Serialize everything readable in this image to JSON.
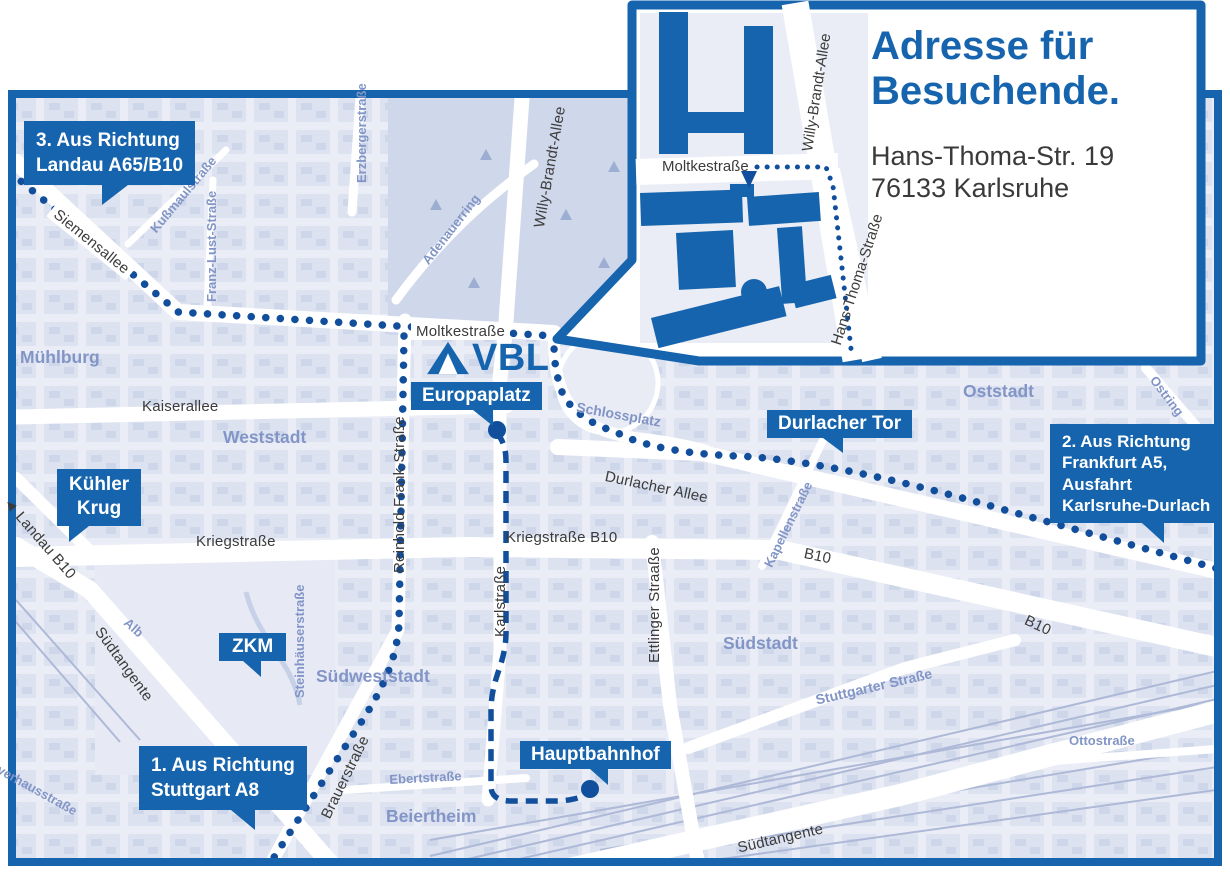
{
  "inset": {
    "title": [
      "Adresse für",
      "Besuchende."
    ],
    "address": [
      "Hans-Thoma-Str. 19",
      "76133 Karlsruhe"
    ],
    "streets": {
      "moltke": "Moltkestraße",
      "willy_brandt": "Willy-Brandt-Allee",
      "hans_thoma": "Hans-Thoma-Straße"
    }
  },
  "logo": {
    "text": "VBL"
  },
  "callouts": {
    "route1": {
      "lines": [
        "1. Aus Richtung",
        "Stuttgart A8"
      ]
    },
    "route2": {
      "lines": [
        "2. Aus Richtung",
        "Frankfurt A5,",
        "Ausfahrt",
        "Karlsruhe-Durlach"
      ]
    },
    "route3": {
      "lines": [
        "3. Aus Richtung",
        "Landau A65/B10"
      ]
    }
  },
  "badges": {
    "europaplatz": "Europaplatz",
    "durlacher_tor": "Durlacher Tor",
    "kuehler_krug": [
      "Kühler",
      "Krug"
    ],
    "zkm": "ZKM",
    "hauptbahnhof": "Hauptbahnhof"
  },
  "roads": {
    "siemensallee": "Siemensallee",
    "kussmaulstrasse": "Kußmaulstraße",
    "franz_lust": "Franz-Lust-Straße",
    "erzbergerstrasse": "Erzbergerstraße",
    "adenauerring": "Adenauerring",
    "willy_brandt": "Willy-Brandt-Allee",
    "moltkestrasse": "Moltkestraße",
    "kaiserallee": "Kaiserallee",
    "reinhold_frank": "Reinhold-Frank-Straße",
    "landau_arrow": "◄",
    "landau": "Landau B10",
    "kriegstrasse": "Kriegstraße",
    "kriegstrasse_b10": "Kriegstraße B10",
    "karlstrasse": "Karlstraße",
    "ettlinger": "Ettlinger Straaße",
    "durlacher_allee": "Durlacher Allee",
    "kapellenstrasse": "Kapellenstraße",
    "b10_west": "B10",
    "b10_east": "B10",
    "ostring": "Ostring",
    "stuttgarter": "Stuttgarter Straße",
    "steinhaeuser": "Steinhäuserstraße",
    "brauerstrasse": "Brauerstraße",
    "ebertstrasse": "Ebertstraße",
    "ottostrasse": "Ottostraße",
    "suedtangente_w": "Südtangente",
    "suedtangente_s": "Südtangente",
    "alb": "Alb",
    "pulverhaus": "verhausstraße"
  },
  "districts": {
    "muehlburg": "Mühlburg",
    "weststadt": "Weststadt",
    "oststadt": "Oststadt",
    "suedstadt": "Südstadt",
    "suedweststadt": "Südweststadt",
    "beiertheim": "Beiertheim"
  },
  "colors": {
    "accent": "#1564AD",
    "route": "#114E9C",
    "district_label": "#8295C6",
    "road_label": "#3B3B3B",
    "map_background": "#EAEDF5"
  }
}
